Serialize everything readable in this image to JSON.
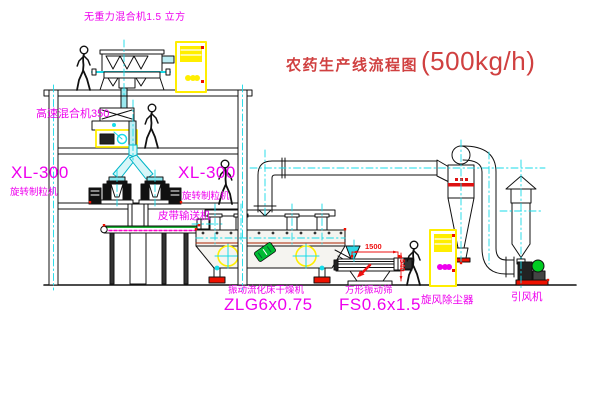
{
  "title": {
    "text_cn": "农药生产线流程图",
    "capacity": "(500kg/h)"
  },
  "labels": {
    "gravity_mixer": "无重力混合机1.5 立方",
    "high_speed_mixer": "高速混合机350",
    "granulator_left_model": "XL-300",
    "granulator_left_name": "旋转制粒机",
    "granulator_center_model": "XL-300",
    "granulator_center_name": "旋转制粒机",
    "belt_conveyor": "皮带输送机",
    "dryer_name": "振动流化床干燥机",
    "dryer_model": "ZLG6x0.75",
    "sieve_name": "方形振动筛",
    "sieve_model": "FS0.6x1.5",
    "cyclone": "旋风除尘器",
    "induced_draft_fan": "引风机"
  },
  "dimensions": {
    "sieve_length": "1500",
    "sieve_height": "540"
  },
  "colors": {
    "magenta": "#ee00ee",
    "title_red": "#d04040",
    "dim_red": "#ee1111",
    "line_black": "#111111",
    "cad_cyan": "#18dbe8",
    "duct_fill": "#d8f6f8",
    "cad_yellow": "#ffee00",
    "cad_green": "#00a81c",
    "base_red": "#ee1100"
  },
  "icons": {
    "person_figure": "walking-outline",
    "center_mark_icon": "circle-cross",
    "brand_logo_icon": "tilted-green-badge",
    "arrow_logo_icon": "red-diagonal-arrow"
  }
}
